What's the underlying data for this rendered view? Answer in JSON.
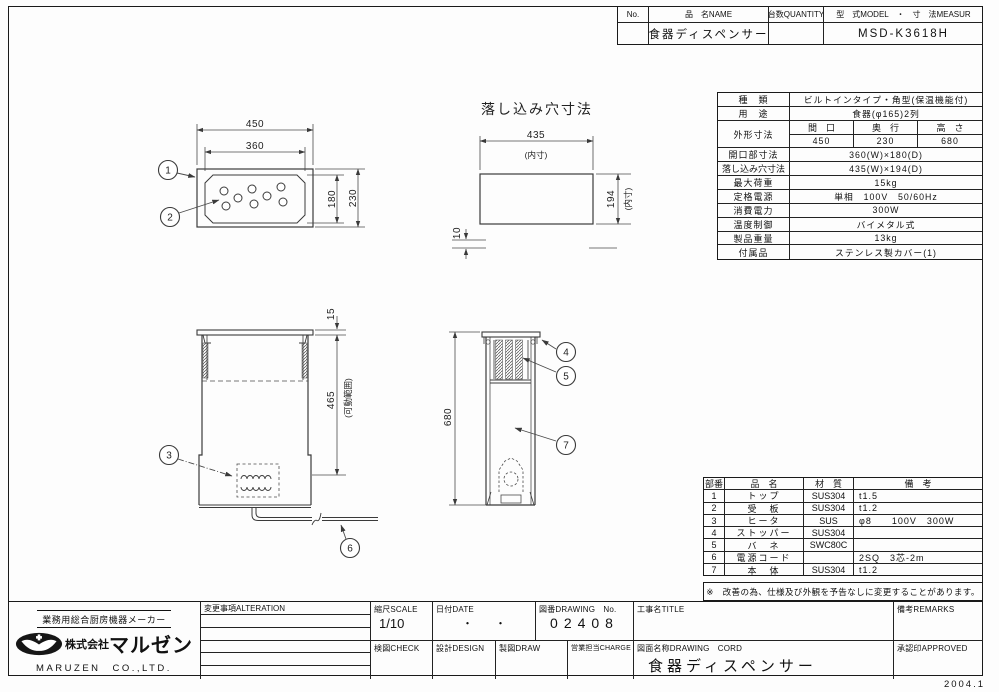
{
  "sheet": {
    "issue_date": "2004.1"
  },
  "header": {
    "col_no": "No.",
    "col_name": "品　名NAME",
    "col_qty": "台数QUANTITY",
    "col_model": "型　式MODEL　・　寸　法MEASUR",
    "val_no": "",
    "val_name": "食器ディスペンサー",
    "val_qty": "",
    "val_model": "MSD-K3618H"
  },
  "spec": {
    "kind_label": "種　類",
    "kind": "ビルトインタイプ・角型(保温機能付)",
    "use_label": "用　途",
    "use": "食器(φ165)2列",
    "outer_label": "外形寸法",
    "outer_c1": "間　口",
    "outer_c2": "奥　行",
    "outer_c3": "高　さ",
    "outer_v1": "450",
    "outer_v2": "230",
    "outer_v3": "680",
    "opening_label": "開口部寸法",
    "opening": "360(W)×180(D)",
    "hole_label": "落し込み穴寸法",
    "hole": "435(W)×194(D)",
    "load_label": "最大荷重",
    "load": "15kg",
    "power_label": "定格電源",
    "power": "単相　100V　50/60Hz",
    "watt_label": "消費電力",
    "watt": "300W",
    "temp_label": "温度制御",
    "temp": "バイメタル式",
    "weight_label": "製品重量",
    "weight": "13kg",
    "acc_label": "付属品",
    "acc": "ステンレス製カバー(1)"
  },
  "parts": {
    "h_no": "部番",
    "h_name": "品　名",
    "h_mat": "材　質",
    "h_rem": "備　考",
    "rows": [
      {
        "no": "1",
        "name": "トップ",
        "mat": "SUS304",
        "rem": "t1.5"
      },
      {
        "no": "2",
        "name": "受　板",
        "mat": "SUS304",
        "rem": "t1.2"
      },
      {
        "no": "3",
        "name": "ヒータ",
        "mat": "SUS",
        "rem": "φ8　　100V　300W"
      },
      {
        "no": "4",
        "name": "ストッパー",
        "mat": "SUS304",
        "rem": ""
      },
      {
        "no": "5",
        "name": "バ　ネ",
        "mat": "SWC80C",
        "rem": ""
      },
      {
        "no": "6",
        "name": "電源コード",
        "mat": "",
        "rem": "2SQ　3芯-2m"
      },
      {
        "no": "7",
        "name": "本　体",
        "mat": "SUS304",
        "rem": "t1.2"
      }
    ],
    "note": "※　改善の為、仕様及び外観を予告なしに変更することがあります。"
  },
  "drawings": {
    "hole_title": "落し込み穴寸法",
    "d450": "450",
    "d360": "360",
    "d180": "180",
    "d230": "230",
    "d435": "435",
    "d435_note": "(内寸)",
    "d194": "194",
    "d194_note": "(内寸)",
    "d10": "10",
    "d15": "15",
    "d465": "465",
    "d465_note": "(可動範囲)",
    "d680": "680",
    "c1": "1",
    "c2": "2",
    "c3": "3",
    "c4": "4",
    "c5": "5",
    "c6": "6",
    "c7": "7"
  },
  "company": {
    "tagline": "業務用総合厨房機器メーカー",
    "prefix": "株式会社",
    "brand": "マルゼン",
    "name_en": "MARUZEN　CO.,LTD."
  },
  "titleblock": {
    "alteration": "変更事項ALTERATION",
    "scale_label": "縮尺SCALE",
    "scale": "1/10",
    "date_label": "日付DATE",
    "date": "・　　・",
    "no_label": "図番DRAWING　No.",
    "no": "02408",
    "title_label": "工事名TITLE",
    "title": "",
    "remarks_label": "備考REMARKS",
    "check_label": "検図CHECK",
    "design_label": "設計DESIGN",
    "draw_label": "製図DRAW",
    "charge_label": "営業担当CHARGE",
    "name_label": "図面名称DRAWING　CORD",
    "name": "食器ディスペンサー",
    "approved_label": "承認印APPROVED"
  }
}
